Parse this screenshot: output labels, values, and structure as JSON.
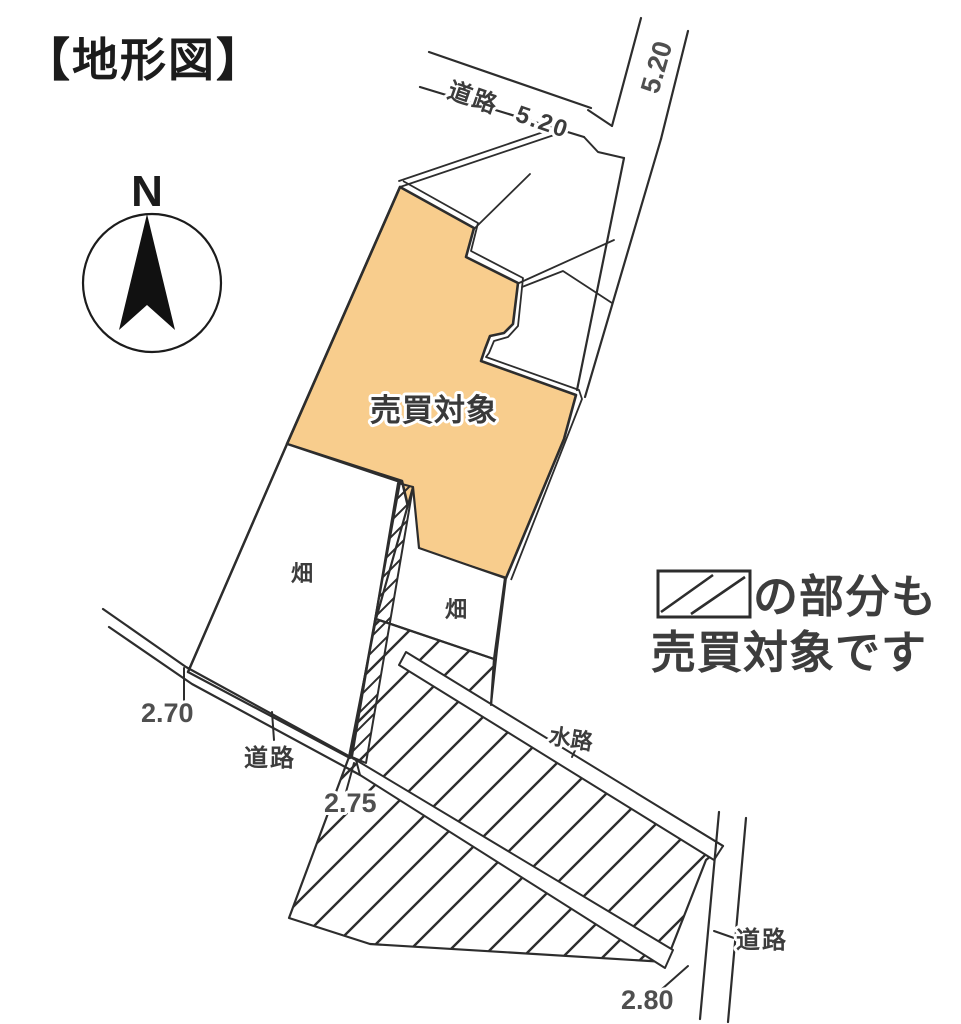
{
  "title": "【地形図】",
  "compass": {
    "north_label": "N"
  },
  "parcels": {
    "sale_parcel_label": "売買対象",
    "field_left_label": "畑",
    "field_right_label": "畑"
  },
  "roads": {
    "top_label": "道路",
    "top_width": "5.20",
    "right_width": "5.20",
    "left_label": "道路",
    "bottom_right_label": "道路",
    "waterway_label": "水路"
  },
  "measurements": {
    "left_width": "2.70",
    "middle_width": "2.75",
    "bottom_width": "2.80"
  },
  "legend": {
    "line1": "の部分も",
    "line2": "売買対象です"
  },
  "colors": {
    "sale_fill": "#F8CD8D",
    "line": "#2d2d2d"
  }
}
